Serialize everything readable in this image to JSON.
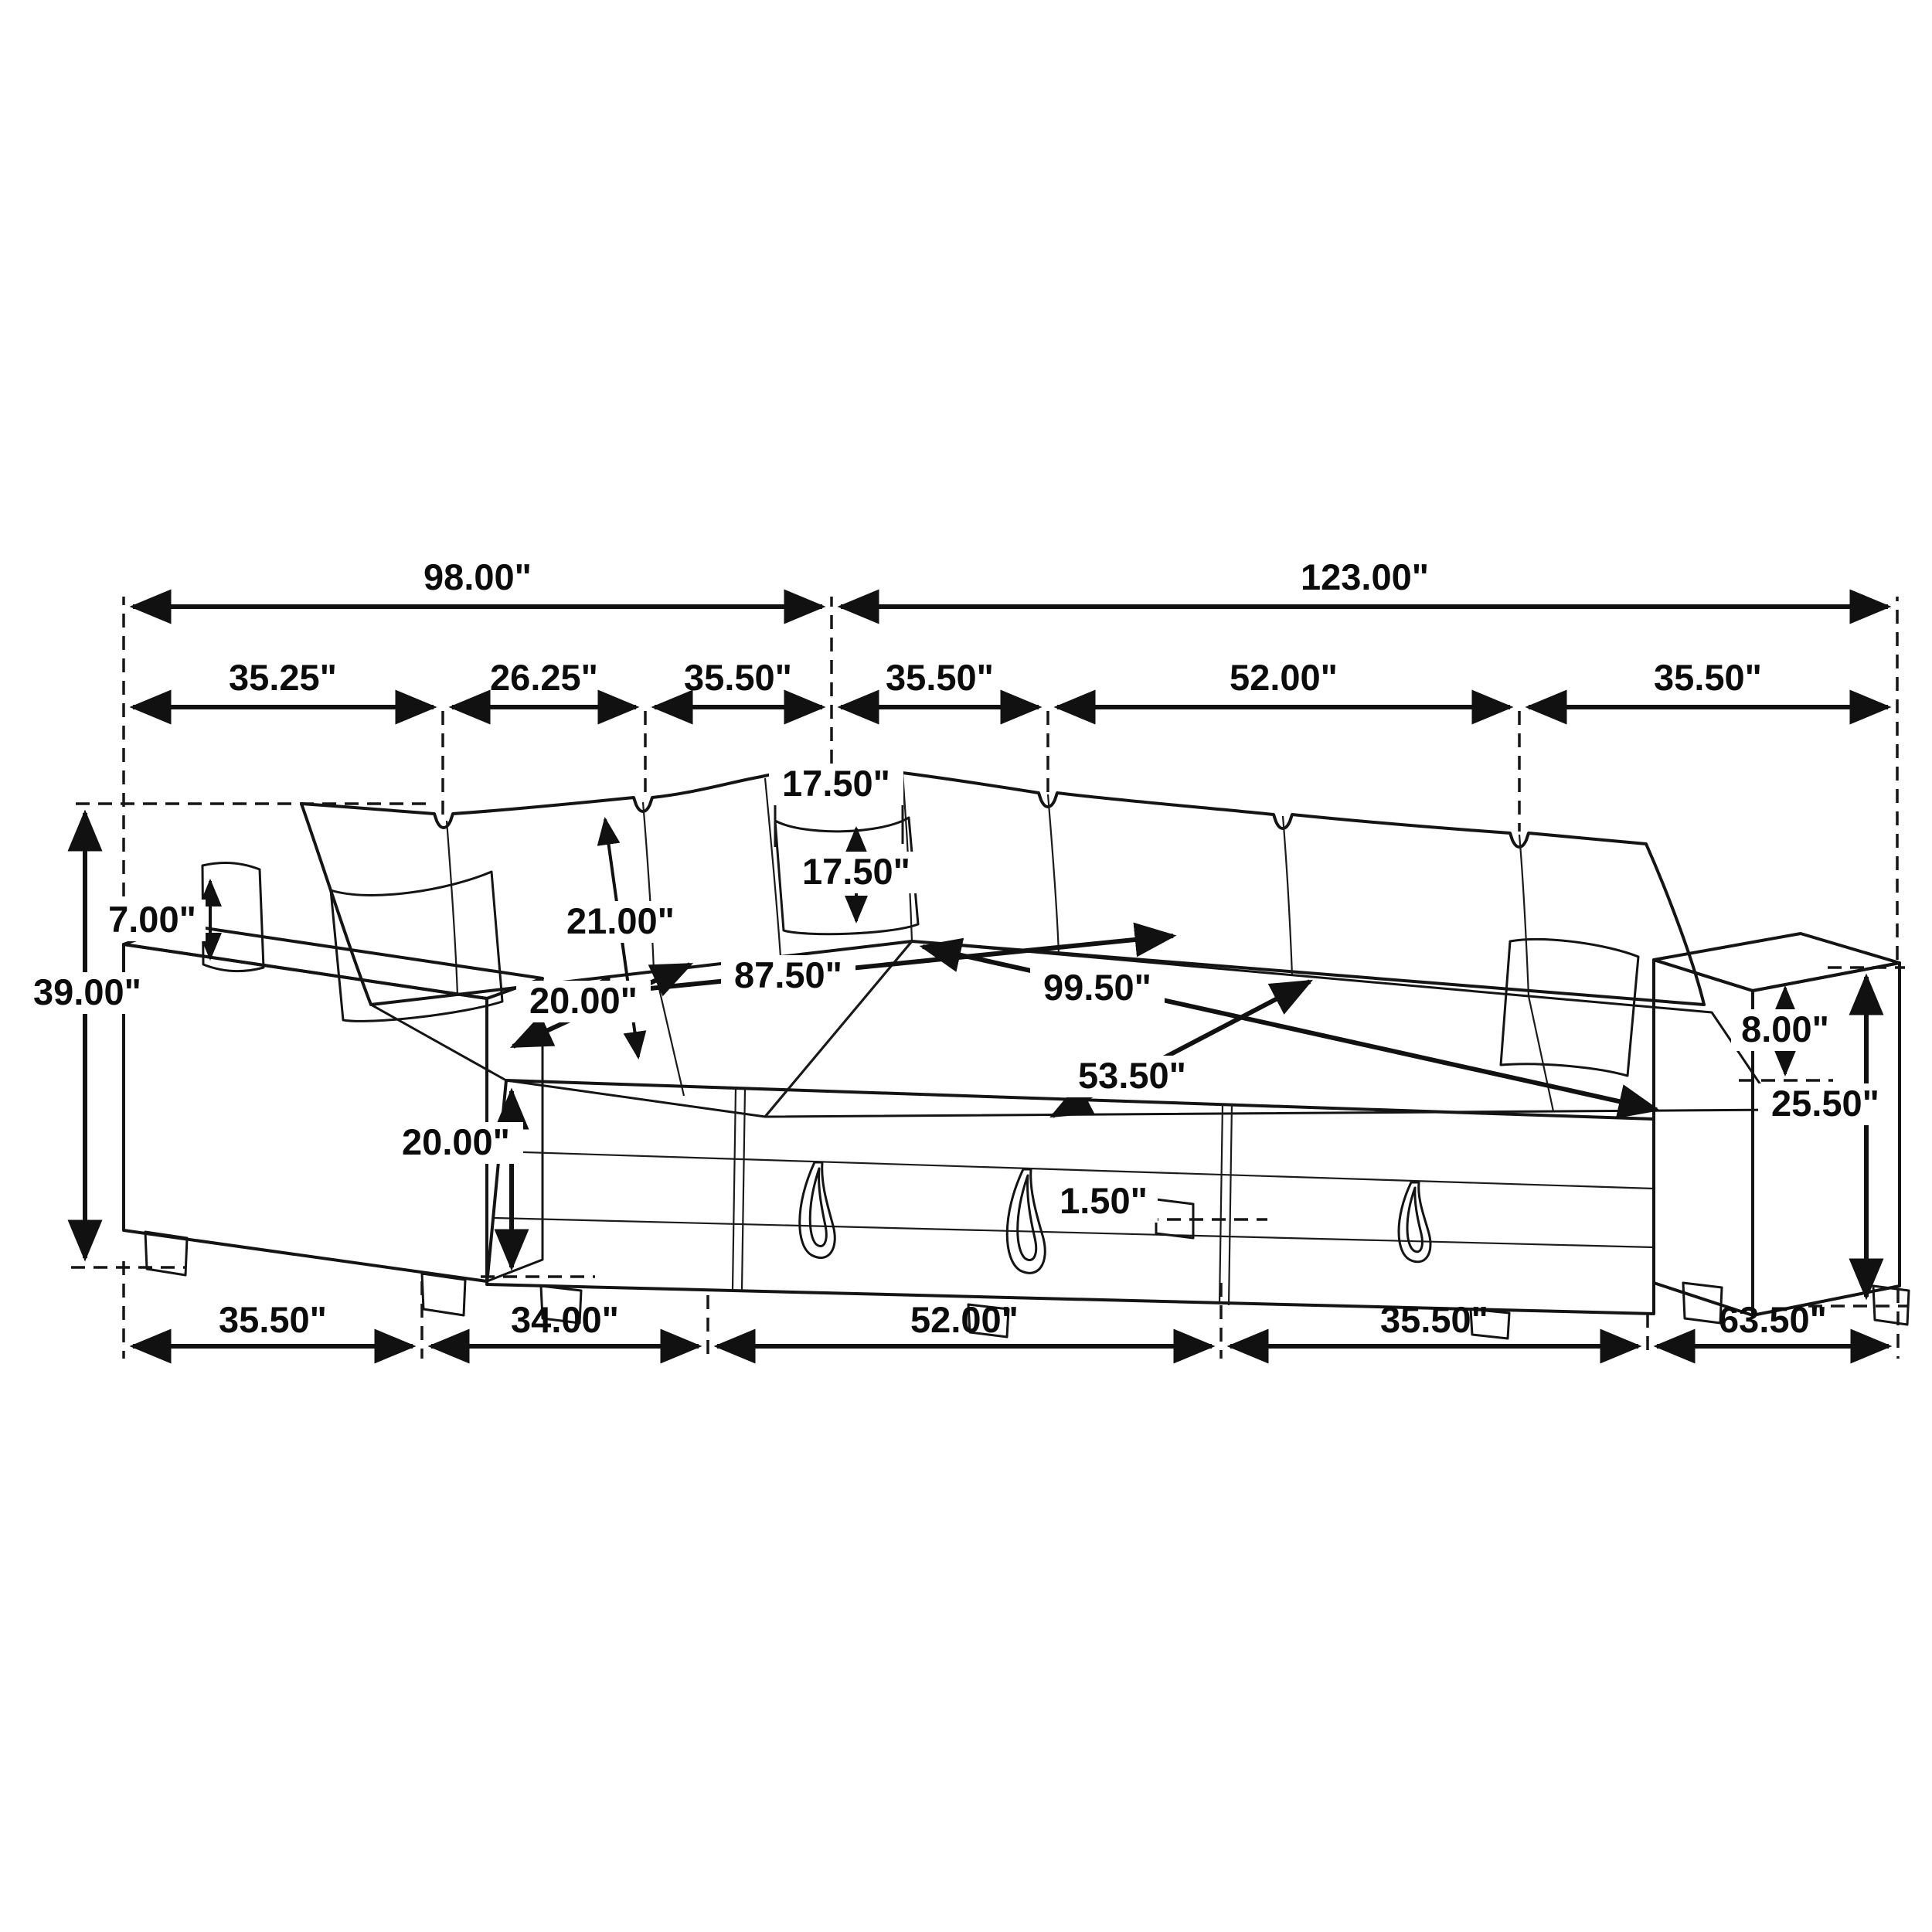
{
  "diagram": {
    "type": "furniture-dimension-drawing",
    "subject": "U-shaped sleeper sectional sofa with pull-out beds, corduroy upholstery (line drawing)",
    "unit": "inches"
  },
  "dims": {
    "top_total_left": "98.00\"",
    "top_total_right": "123.00\"",
    "seg_arm_left": "35.25\"",
    "seg_seat_a": "26.25\"",
    "seg_seat_b": "35.50\"",
    "seg_corner": "35.50\"",
    "seg_right_mid": "52.00\"",
    "seg_arm_right_top": "35.50\"",
    "overall_height": "39.00\"",
    "pillow_above_arm": "7.00\"",
    "back_height": "21.00\"",
    "pillow_width": "17.50\"",
    "pillow_height": "17.50\"",
    "seat_depth": "20.00\"",
    "bed_length_left": "87.50\"",
    "bed_length_right": "99.50\"",
    "bed_width": "53.50\"",
    "seat_height": "20.00\"",
    "arm_above_seat": "8.00\"",
    "arm_height_right": "25.50\"",
    "leg_clearance": "1.50\"",
    "bottom_arm_left": "35.50\"",
    "bottom_chaise": "34.00\"",
    "bottom_bed": "52.00\"",
    "bottom_ottoman": "35.50\"",
    "bottom_right_depth": "63.50\""
  }
}
